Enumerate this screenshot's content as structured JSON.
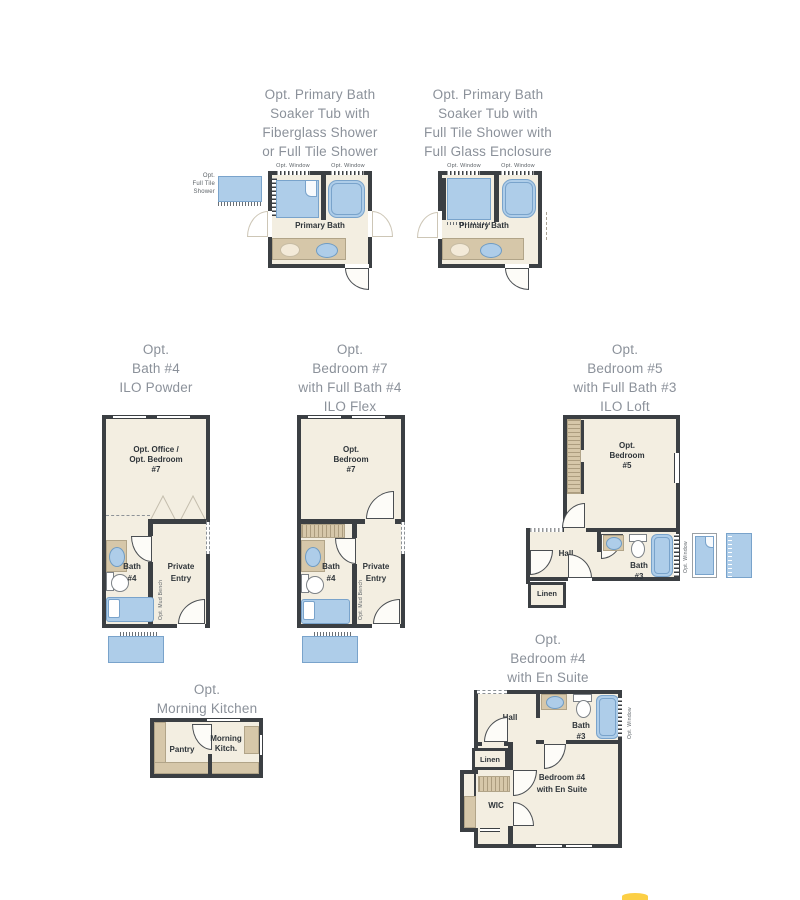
{
  "colors": {
    "wall": "#3b3f43",
    "floor": "#f3eee1",
    "fixture_blue": "#aecde9",
    "fixture_border": "#79a3cb",
    "counter_tan": "#d6c7a9",
    "title_text": "#8b919a",
    "label_text": "#2e3439",
    "small_text": "#5d6368",
    "logo_yellow": "#fccf45"
  },
  "titles": {
    "primary_bath_fiberglass": [
      "Opt. Primary Bath",
      "Soaker Tub with",
      "Fiberglass Shower",
      "or Full Tile Shower"
    ],
    "primary_bath_full_tile": [
      "Opt. Primary Bath",
      "Soaker Tub with",
      "Full Tile Shower with",
      "Full Glass Enclosure"
    ],
    "bath4_ilo_powder": [
      "Opt.",
      "Bath #4",
      "ILO Powder"
    ],
    "bedroom7_ilo_flex": [
      "Opt.",
      "Bedroom #7",
      "with Full Bath #4",
      "ILO Flex"
    ],
    "bedroom5_ilo_loft": [
      "Opt.",
      "Bedroom #5",
      "with Full Bath #3",
      "ILO Loft"
    ],
    "morning_kitchen": [
      "Opt.",
      "Morning Kitchen"
    ],
    "bedroom4_ensuite": [
      "Opt.",
      "Bedroom #4",
      "with En Suite"
    ]
  },
  "labels": {
    "opt_window": "Opt. Window",
    "full_tile_option": [
      "Opt.",
      "Full Tile",
      "Shower"
    ],
    "primary_bath": "Primary Bath",
    "office": [
      "Opt. Office /",
      "Opt. Bedroom",
      "#7"
    ],
    "bedroom7": [
      "Opt.",
      "Bedroom",
      "#7"
    ],
    "bedroom5": [
      "Opt.",
      "Bedroom",
      "#5"
    ],
    "bath4": [
      "Bath",
      "#4"
    ],
    "private_entry": [
      "Private",
      "Entry"
    ],
    "mud_bench": "Opt. Mud Bench",
    "hall": "Hall",
    "bath3": [
      "Bath",
      "#3"
    ],
    "linen": "Linen",
    "pantry": "Pantry",
    "morning_kitchen_room": [
      "Morning",
      "Kitch."
    ],
    "wic": "WIC",
    "bedroom4": [
      "Bedroom #4",
      "with En Suite"
    ]
  }
}
